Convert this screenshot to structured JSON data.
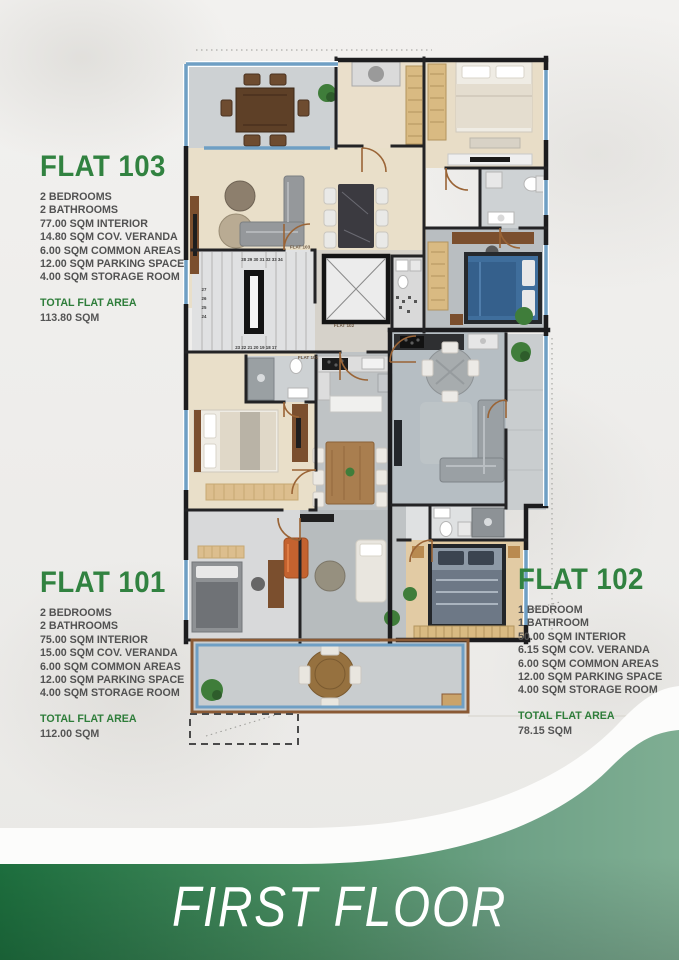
{
  "banner": {
    "title": "FIRST FLOOR"
  },
  "colors": {
    "accent_green": "#318240",
    "banner_green_dark": "#1d6f3e",
    "banner_green_sage": "#7fae93",
    "window_blue": "#6f9fc4",
    "wall_black": "#1c1c1e",
    "door_brown": "#9a6436"
  },
  "flats": [
    {
      "name": "FLAT 103",
      "specs": [
        "2 BEDROOMS",
        "2 BATHROOMS",
        "77.00 SQM INTERIOR",
        "14.80 SQM COV. VERANDA",
        "6.00 SQM COMMON AREAS",
        "12.00 SQM PARKING SPACE",
        "4.00 SQM STORAGE ROOM"
      ],
      "total_label": "TOTAL FLAT AREA",
      "total_value": "113.80 SQM"
    },
    {
      "name": "FLAT 101",
      "specs": [
        "2 BEDROOMS",
        "2 BATHROOMS",
        "75.00 SQM INTERIOR",
        "15.00 SQM COV. VERANDA",
        "6.00 SQM COMMON AREAS",
        "12.00 SQM PARKING SPACE",
        "4.00 SQM STORAGE ROOM"
      ],
      "total_label": "TOTAL FLAT AREA",
      "total_value": "112.00 SQM"
    },
    {
      "name": "FLAT 102",
      "specs": [
        "1 BEDROOM",
        "1 BATHROOM",
        "50.00 SQM INTERIOR",
        "6.15 SQM COV. VERANDA",
        "6.00 SQM COMMON AREAS",
        "12.00 SQM PARKING SPACE",
        "4.00 SQM STORAGE ROOM"
      ],
      "total_label": "TOTAL FLAT AREA",
      "total_value": "78.15 SQM"
    }
  ],
  "plan": {
    "door_labels": {
      "flat103": "FLAT 103",
      "flat102": "FLAT 102",
      "flat101": "FLAT 101"
    },
    "stairs": {
      "top": "28 29 30 31 32 33 34",
      "left": [
        "27",
        "26",
        "25",
        "24"
      ],
      "bottom": "23 22 21 20 19 18 17"
    }
  }
}
